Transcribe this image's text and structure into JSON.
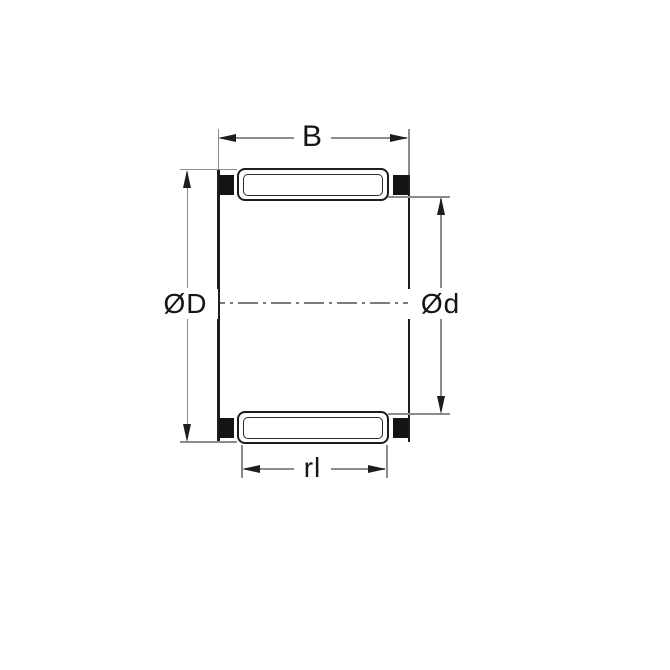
{
  "drawing": {
    "labels": {
      "b": "B",
      "outer_diameter": "ØD",
      "inner_diameter": "Ød",
      "roller_length": "rl"
    },
    "colors": {
      "outline": "#1d1d1d",
      "cage_block": "#141414",
      "dimension_line": "#8c8c8c",
      "centerline": "#7d7d7d",
      "background": "#ffffff",
      "text": "#151515"
    }
  }
}
